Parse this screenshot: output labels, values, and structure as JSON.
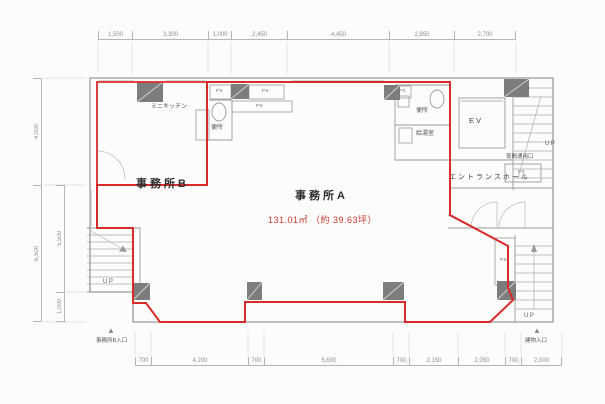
{
  "units": {
    "a": {
      "name": "事務所A",
      "area": "131.01㎡ （約 39.63坪）"
    },
    "b": {
      "name": "事務所B"
    }
  },
  "rooms": {
    "mini_kitchen": "ミニキッチン",
    "toilet": "便所",
    "kitchenette": "給湯室",
    "elevator": "EV",
    "entrance_hall": "エントランスホール",
    "night_entrance": "夜間通用口",
    "pipe_space": "PS",
    "stairs_up": "UP"
  },
  "markers": {
    "office_b_entrance": "事務所B入口",
    "building_entrance": "建物入口",
    "arrow": "▲"
  },
  "dimensions": {
    "top": [
      "1,500",
      "3,300",
      "1,000",
      "2,450",
      "4,450",
      "2,850",
      "2,700"
    ],
    "bottom": [
      "700",
      "4,200",
      "700",
      "5,600",
      "700",
      "2,150",
      "2,050",
      "700",
      "2,000"
    ],
    "left_outer": [
      "4,000",
      "6,500"
    ],
    "left_inner": [
      "5,500",
      "1,000"
    ]
  },
  "colors": {
    "unit_outline": "#d92b2b",
    "area_text": "#c63a2e",
    "wall": "#9a9a9a",
    "column": "#7d7d7d",
    "dim": "#8f8f8f"
  }
}
